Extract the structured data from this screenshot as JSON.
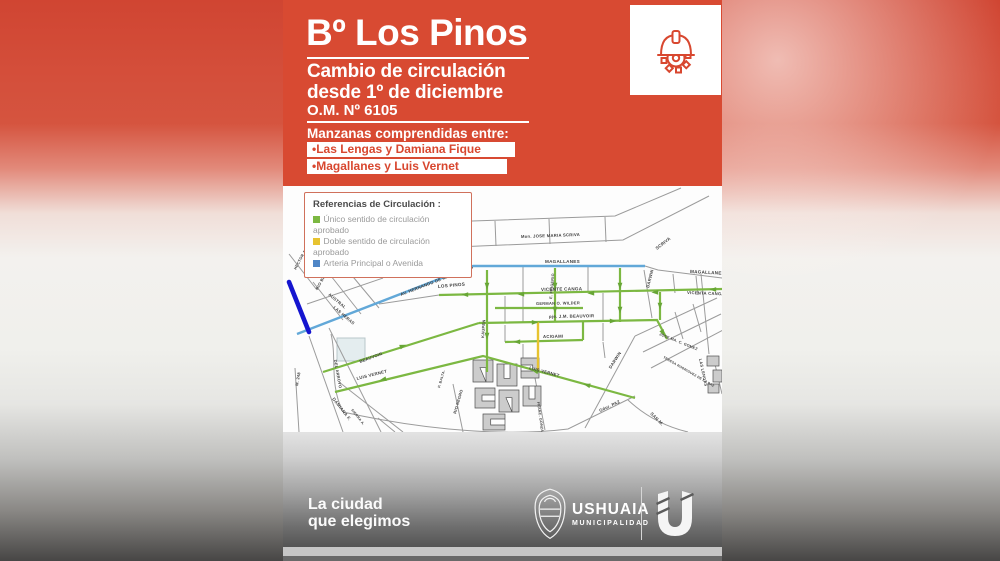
{
  "poster": {
    "title": "Bº Los Pinos",
    "subtitle_line1": "Cambio de circulación",
    "subtitle_line2": "desde 1º de diciembre",
    "ordinance": "O.M. Nº 6105",
    "blocks_heading": "Manzanas comprendidas entre:",
    "block_items": [
      "•Las Lengas y Damiana Fique",
      "•Magallanes y Luis Vernet"
    ]
  },
  "legend": {
    "title": "Referencias de Circulación :",
    "items": [
      {
        "label": "Único sentido de circulación aprobado",
        "color": "#7cb842"
      },
      {
        "label": "Doble sentido de circulación aprobado",
        "color": "#e7c330"
      },
      {
        "label": "Arteria Principal o Avenida",
        "color": "#4f86c6"
      }
    ]
  },
  "map": {
    "street_labels": [
      {
        "text": "Mon. JOSE MARIA SCRIVA",
        "x": 238,
        "y": 52,
        "r": -2,
        "s": 4.2
      },
      {
        "text": "SCRIVA",
        "x": 374,
        "y": 64,
        "r": -38,
        "s": 4.4
      },
      {
        "text": "MAGALLANES",
        "x": 262,
        "y": 77,
        "r": 0,
        "s": 4.6
      },
      {
        "text": "MAGALLANES",
        "x": 407,
        "y": 87,
        "r": 3,
        "s": 4.6
      },
      {
        "text": "AV. HERNANDO DE MAGALLANES",
        "x": 118,
        "y": 110,
        "r": -21,
        "s": 4.3
      },
      {
        "text": "LOS PINOS",
        "x": 155,
        "y": 102,
        "r": -5,
        "s": 4.6
      },
      {
        "text": "VICENTE CANGA",
        "x": 258,
        "y": 105,
        "r": -1,
        "s": 4.6
      },
      {
        "text": "VICENTA CANGA",
        "x": 404,
        "y": 108,
        "r": 2,
        "s": 4.2
      },
      {
        "text": "DARWIN",
        "x": 366,
        "y": 102,
        "r": -76,
        "s": 4.2
      },
      {
        "text": "E. FRIGERIO",
        "x": 269,
        "y": 113,
        "r": -85,
        "s": 3.8
      },
      {
        "text": "KAUPEN",
        "x": 201,
        "y": 152,
        "r": -86,
        "s": 4
      },
      {
        "text": "GERMAN O. WILDER",
        "x": 253,
        "y": 119,
        "r": -1,
        "s": 4
      },
      {
        "text": "pje. J.M. BEAUVOIR",
        "x": 266,
        "y": 132,
        "r": -1,
        "s": 4.3
      },
      {
        "text": "ACIGAMI",
        "x": 260,
        "y": 152,
        "r": -1,
        "s": 4.3
      },
      {
        "text": "AUSTRAL",
        "x": 45,
        "y": 109,
        "r": 40,
        "s": 4.2
      },
      {
        "text": "LAS HERAS",
        "x": 50,
        "y": 122,
        "r": 40,
        "s": 4.2
      },
      {
        "text": "RIO BERMEJO",
        "x": 35,
        "y": 104,
        "r": -62,
        "s": 4
      },
      {
        "text": "HECTOR A. LLANOS",
        "x": 13,
        "y": 84,
        "r": -62,
        "s": 3.8
      },
      {
        "text": "DEL ARROYO",
        "x": 51,
        "y": 174,
        "r": 80,
        "s": 4
      },
      {
        "text": "BEAUVOIR",
        "x": 77,
        "y": 177,
        "r": -20,
        "s": 4.2
      },
      {
        "text": "LUIS VERNET",
        "x": 74,
        "y": 194,
        "r": -14,
        "s": 4.3
      },
      {
        "text": "LUIS VERNET",
        "x": 246,
        "y": 183,
        "r": 15,
        "s": 4.3
      },
      {
        "text": "DAMIANA F.",
        "x": 49,
        "y": 213,
        "r": 52,
        "s": 4.4
      },
      {
        "text": "SIERRA A.",
        "x": 68,
        "y": 224,
        "r": 52,
        "s": 3.5
      },
      {
        "text": "M. 248",
        "x": 15,
        "y": 200,
        "r": -80,
        "s": 4
      },
      {
        "text": "RIO NEGRO",
        "x": 173,
        "y": 228,
        "r": -74,
        "s": 4
      },
      {
        "text": "P. BALTA.",
        "x": 157,
        "y": 202,
        "r": -74,
        "s": 3.5
      },
      {
        "text": "FRANC. GONZALEZ",
        "x": 254,
        "y": 216,
        "r": 82,
        "s": 3.6
      },
      {
        "text": "Gdor. PAZ",
        "x": 317,
        "y": 226,
        "r": -25,
        "s": 4.2
      },
      {
        "text": "SAN M.",
        "x": 367,
        "y": 228,
        "r": 45,
        "s": 4.4
      },
      {
        "text": "DARWIN",
        "x": 328,
        "y": 183,
        "r": -57,
        "s": 4.3
      },
      {
        "text": "JOSE MA. C. GOMEZ",
        "x": 376,
        "y": 149,
        "r": 22,
        "s": 3.7
      },
      {
        "text": "TERESA RODRIGUEZ DE LA PAZ",
        "x": 380,
        "y": 172,
        "r": 30,
        "s": 3.3
      },
      {
        "text": "LAS LENGAS",
        "x": 416,
        "y": 173,
        "r": 78,
        "s": 4
      }
    ]
  },
  "footer": {
    "tagline_line1": "La ciudad",
    "tagline_line2": "que elegimos",
    "brand_name": "USHUAIA",
    "brand_subtitle": "MUNICIPALIDAD"
  },
  "colors": {
    "accent_red": "#d8472f",
    "one_way_green": "#7cb842",
    "two_way_yellow": "#e7c330",
    "avenue_blue": "#62a8d8",
    "principal_navy": "#1515cf"
  }
}
